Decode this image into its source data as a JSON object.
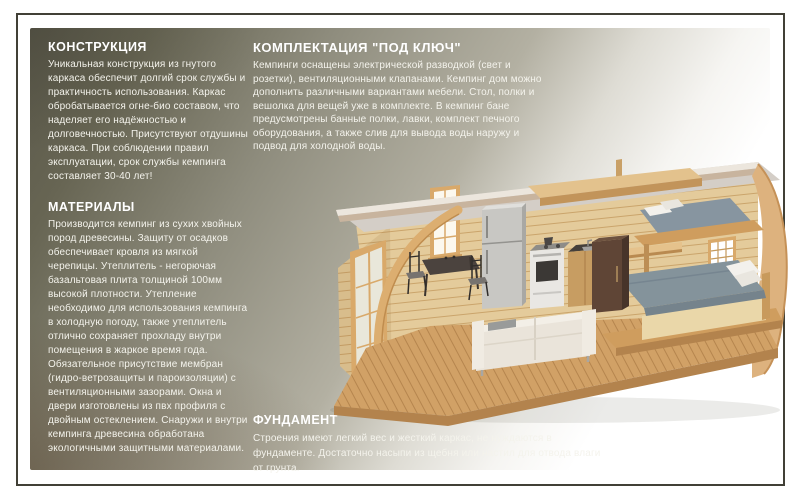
{
  "panel": {
    "bg_dark": "#5a584a",
    "bg_mid": "#b3b0a2",
    "bg_light": "#ffffff",
    "border_color": "#414036",
    "text_color": "#ffffff"
  },
  "sections": {
    "construction": {
      "title": "КОНСТРУКЦИЯ",
      "body": "Уникальная конструкция из гнутого каркаса обеспечит долгий срок службы и практичность использования. Каркас обробатывается огне-био составом, что наделяет его надёжностью и долговечностью. Присутствуют отдушины каркаса. При соблюдении правил эксплуатации, срок службы кемпинга составляет 30-40 лет!"
    },
    "materials": {
      "title": "МАТЕРИАЛЫ",
      "body": "Производится кемпинг из сухих хвойных пород древесины. Защиту от осадков обеспечивает кровля из мягкой черепицы.  Утеплитель - негорючая базальтовая плита толщиной 100мм высокой плотности. Утепление необходимо для использования кемпинга в холодную погоду, также утеплитель отлично сохраняет прохладу внутри помещения в жаркое время года. Обязательное присутствие мембран (гидро-ветрозащиты и пароизоляции) с вентиляционными зазорами. Окна и двери изготовлены из пвх профиля с двойным остеклением. Снаружи и внутри кемпинга древесина обработана экологичными  защитными материалами."
    },
    "package": {
      "title": "КОМПЛЕКТАЦИЯ \"ПОД КЛЮЧ\"",
      "body": "Кемпинги оснащены электрической разводкой (свет и розетки), вентиляционными клапанами. Кемпинг дом можно дополнить различными вариантами мебели. Стол, полки и вешолка для вещей уже в комплекте. В кемпинг бане предусмотрены банные полки, лавки, комплект печного оборудования, а также слив для вывода воды наружу и подвод для холодной воды."
    },
    "foundation": {
      "title": "ФУНДАМЕНТ",
      "body": "Строения имеют легкий вес и жесткий каркас, не нуждаются в фундаменте. Достаточно насыпи из щебня или настил для отвода влаги от грунта."
    }
  },
  "illustration": {
    "description": "3D-разрез деревянного кемпинг-дома: кухня с холодильником и плитой, обеденный стол со стульями, двухъярусное спальное место, двуспальная кровать, диван и терраса"
  }
}
